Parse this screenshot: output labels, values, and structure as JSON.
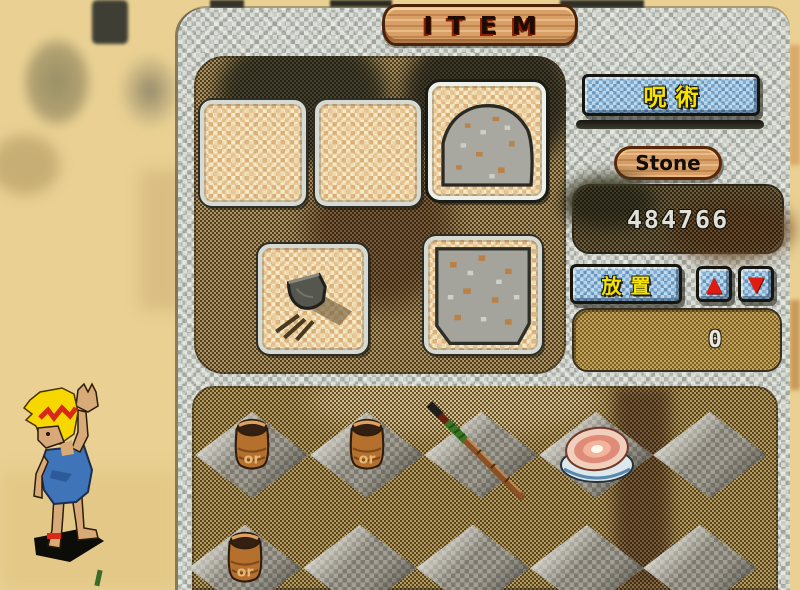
{
  "window": {
    "title": "ITEM"
  },
  "right_panel": {
    "magic_button_label": "呪術",
    "item_name": "Stone",
    "item_quantity": "484766",
    "place_button_label": "放置",
    "selected_count": "0",
    "icons": {
      "up": "▲",
      "down": "▼"
    }
  },
  "inventory": {
    "slots": [
      {
        "name": "slot-empty-1",
        "item": "empty"
      },
      {
        "name": "slot-empty-2",
        "item": "empty"
      },
      {
        "name": "slot-stone-boulder",
        "item": "stone-boulder",
        "selected": true
      },
      {
        "name": "slot-cooking-pot",
        "item": "cooking-pot"
      },
      {
        "name": "slot-stone-block",
        "item": "stone-block"
      }
    ]
  },
  "ground": {
    "barrel_label": "or",
    "rows": [
      {
        "tiles": [
          "barrel",
          "barrel",
          "spear",
          "meat",
          "empty"
        ]
      },
      {
        "tiles": [
          "barrel",
          "empty",
          "empty",
          "empty",
          "empty"
        ]
      }
    ]
  },
  "colors": {
    "accent_yellow": "#f6e400",
    "button_blue": "#7cb0d6",
    "arrow_red": "#e01c10",
    "wood": "#d89f66",
    "panel_stone": "#c9cdc4",
    "sand": "#ead193"
  }
}
